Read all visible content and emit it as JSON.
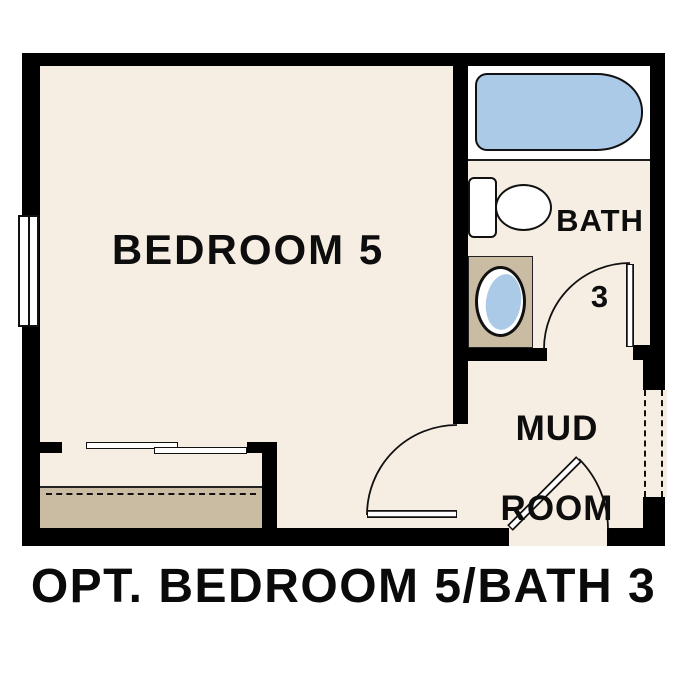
{
  "title": "OPT. BEDROOM 5/BATH 3",
  "rooms": {
    "bedroom": {
      "label": "BEDROOM 5"
    },
    "bath": {
      "line1": "BATH",
      "line2": "3"
    },
    "mudroom": {
      "line1": "MUD",
      "line2": "ROOM"
    }
  },
  "fixtures": {
    "bathtub": "bathtub",
    "toilet": "toilet",
    "sink": "vanity-sink",
    "closet": "sliding-bypass-closet-doors",
    "shelf": "closet-shelf-and-rod",
    "window": "window",
    "doors": [
      "bedroom-swing-door",
      "bath-swing-door",
      "mudroom-swing-door"
    ],
    "optional_opening": "dashed-optional-opening"
  },
  "colors": {
    "wall": "#000000",
    "floor": "#f6eee2",
    "fixture_blue": "#abcae8",
    "casework_tan": "#c9bca3",
    "tub_alcove": "#ffffff",
    "text": "#0d0d0d"
  }
}
